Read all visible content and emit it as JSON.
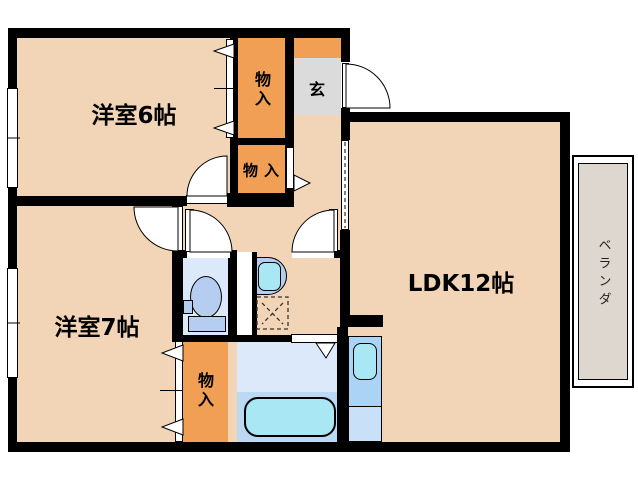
{
  "plan": {
    "title": "apartment-floor-plan",
    "rooms": {
      "bedroom6": "洋室6帖",
      "bedroom7": "洋室7帖",
      "ldk": "LDK12帖",
      "genkan": "玄",
      "veranda": "ベランダ",
      "closet_top": "物入",
      "closet_mid": "物入",
      "closet_b7": "物入"
    },
    "colors": {
      "floor": "#f2d5b7",
      "closet": "#f09f55",
      "genkan_floor": "#dbdbdb",
      "wet_floor": "#dbe9fb",
      "bath_lower": "#bcd9f4",
      "fixture_blue": "#b6cdf2",
      "fixture_cyan": "#a8e7f3",
      "kitchen_upper": "#abd3f6",
      "kitchen_lower": "#c8e1f9",
      "veranda_floor": "#ded7d0",
      "wall": "#000000"
    }
  }
}
